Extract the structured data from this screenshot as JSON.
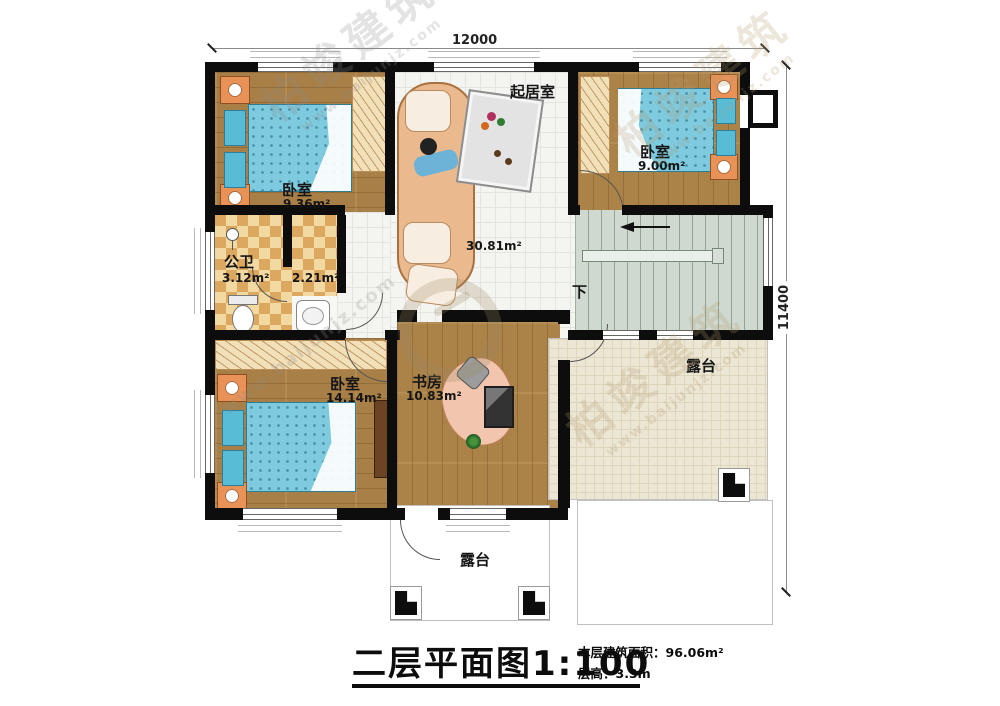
{
  "plan": {
    "dim_top": "12000",
    "dim_right": "11400",
    "stairs_down_label": "下"
  },
  "rooms": {
    "living": {
      "name": "起居室",
      "area": "30.81m²"
    },
    "bedroom_top_left": {
      "name": "卧室",
      "area": "9.36m²"
    },
    "bedroom_top_right": {
      "name": "卧室",
      "area": "9.00m²"
    },
    "bathroom": {
      "name": "公卫",
      "area": "3.12m²"
    },
    "closet": {
      "area": "2.21m²"
    },
    "bedroom_bottom_left": {
      "name": "卧室",
      "area": "14.14m²"
    },
    "study": {
      "name": "书房",
      "area": "10.83m²"
    },
    "terrace_right": {
      "name": "露台"
    },
    "terrace_bottom": {
      "name": "露台"
    }
  },
  "title_block": {
    "title": "二层平面图1:100",
    "floor_area": "本层建筑面积：96.06m²",
    "floor_height": "层高：3.3m"
  },
  "watermark": {
    "brand": "柏竣建筑",
    "url": "www.baijunjz.com"
  },
  "colors": {
    "wall": "#0d0d0d",
    "wood_floor": "#a87f46",
    "bath_checker": "#dca75f",
    "living_tile": "#f4f4f1",
    "terrace_tile": "#ece6d4",
    "stairs": "#cfd9cf",
    "bed": "#7ecade",
    "nightstand": "#e89258",
    "sofa": "#eab98d"
  }
}
